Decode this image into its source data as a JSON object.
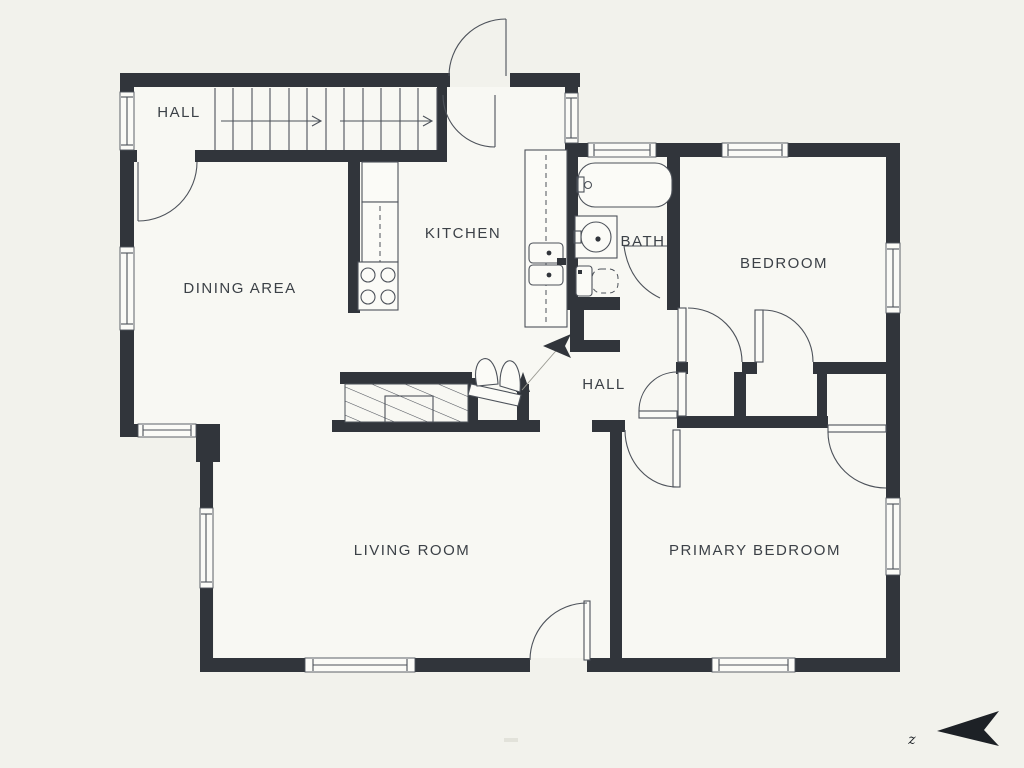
{
  "title": "Floor plan",
  "colors": {
    "background": "#f2f2ec",
    "floor": "#f8f8f3",
    "wall": "#31353b",
    "line": "#4d525a",
    "text": "#3c4147",
    "dark": "#1d2126",
    "fixture": "#fbfbf7"
  },
  "rooms": {
    "hall_upper": {
      "label": "HALL"
    },
    "dining": {
      "label": "DINING AREA"
    },
    "kitchen": {
      "label": "KITCHEN"
    },
    "bath": {
      "label": "BATH"
    },
    "bedroom": {
      "label": "BEDROOM"
    },
    "hall": {
      "label": "HALL"
    },
    "living": {
      "label": "LIVING ROOM"
    },
    "primary": {
      "label": "PRIMARY BEDROOM"
    }
  },
  "compass": {
    "label": "z"
  },
  "fixtures": [
    "stairs",
    "entry-door",
    "fireplace",
    "bifold-closet",
    "refrigerator",
    "counter",
    "stove",
    "kitchen-sink",
    "bathtub",
    "vanity-sink",
    "toilet",
    "closets",
    "windows"
  ]
}
